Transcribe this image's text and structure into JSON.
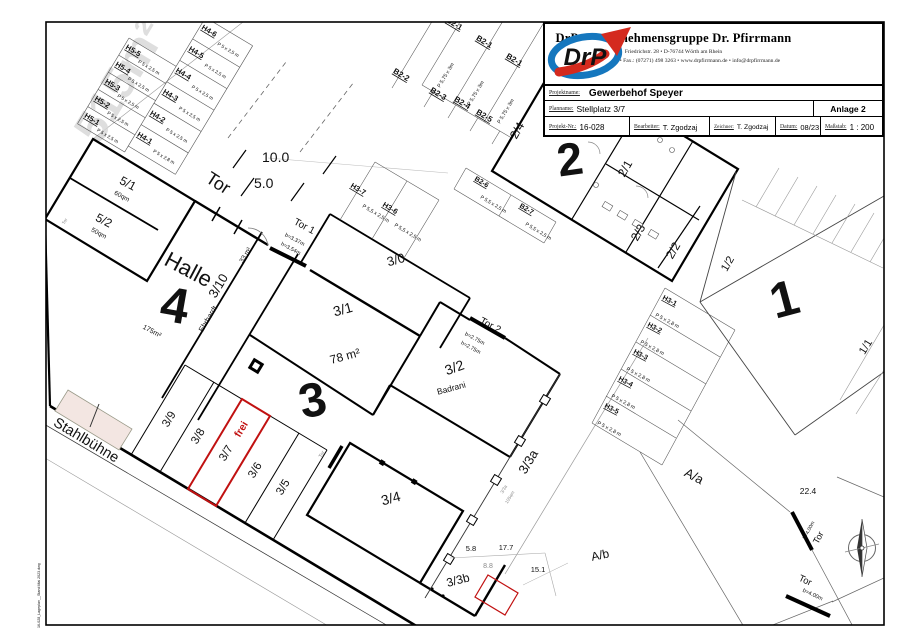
{
  "tb": {
    "company": "DrP - Unternehmensgruppe Dr. Pfirrmann",
    "address": "Friedrichstr. 28  •  D-76744 Wörth am Rhein",
    "contact": "Tel.: (07271) 498 2771  •  Fax.: (07271) 498 3263  •  www.drpfirrmann.de  •  info@drpfirrmann.de",
    "logo": "DrP",
    "projektname_label": "Projektname:",
    "projektname": "Gewerbehof Speyer",
    "planname_label": "Planname:",
    "planname": "Stellplatz 3/7",
    "anlage": "Anlage 2",
    "pnr_label": "Projekt-Nr.:",
    "pnr": "16-028",
    "bearb_label": "Bearbeiter:",
    "bearb": "T. Zgodzaj",
    "zeich_label": "Zeichner:",
    "zeich": "T. Zgodzaj",
    "datum_label": "Datum:",
    "datum": "08/23",
    "mass_label": "Maßstab:",
    "mass": "1 : 200"
  },
  "plan": {
    "watermark": "515m²",
    "scale10": "10.0",
    "scale5": "5.0",
    "street": "Stahlbühne",
    "filenote": "16-028_Lageplan__Stand Mai 2023.dwg",
    "big1": "1",
    "big2": "2",
    "big3": "3",
    "big4": "4",
    "halle": "Halle",
    "halle_area": "175m²"
  },
  "rooms": {
    "r51": "5/1",
    "r51a": "60qm",
    "r52": "5/2",
    "r52a": "50qm",
    "r310": "3/10",
    "r310a": "33 m²",
    "r310t": "Ehrhardt",
    "r30": "3/0",
    "r31": "3/1",
    "r31a": "78 m²",
    "r32": "3/2",
    "r32t": "Badrani",
    "r34": "3/4",
    "r33a": "3/3a",
    "r33a_note": "3/3a",
    "r33a_area": "105qm",
    "r33b": "3/3b",
    "r24": "2/4",
    "r21": "2/1",
    "r23": "2/3",
    "r22": "2/2",
    "r12": "1/2",
    "r11": "1/1",
    "aa": "A/a",
    "ab": "A/b",
    "r39": "3/9",
    "r38": "3/8",
    "r37": "3/7",
    "frei": "frei",
    "r36": "3/6",
    "r35": "3/5"
  },
  "stalls": {
    "h5": [
      {
        "id": "H5-5",
        "size": "P 5 x 2,5 m"
      },
      {
        "id": "H5-4",
        "size": "P 5 x 2,5 m"
      },
      {
        "id": "H5-3",
        "size": "P 5 x 2,5 m"
      },
      {
        "id": "H5-2",
        "size": "P 5 x 2,5 m"
      },
      {
        "id": "H5-1",
        "size": "P 5 x 2,5 m"
      }
    ],
    "h4": [
      {
        "id": "H4-6",
        "size": "P 5 x 2,5 m"
      },
      {
        "id": "H4-5",
        "size": "P 5 x 2,5 m"
      },
      {
        "id": "H4-4",
        "size": "P 5 x 2,5 m"
      },
      {
        "id": "H4-3",
        "size": "P 5 x 2,5 m"
      },
      {
        "id": "H4-2",
        "size": "P 5 x 2,5 m"
      },
      {
        "id": "H4-1",
        "size": "P 5 x 2,8 m"
      }
    ],
    "h3m": [
      {
        "id": "H3-7",
        "size": "P 5,5 x 2,5 m"
      },
      {
        "id": "H3-6",
        "size": "P 5,5 x 2,5 m"
      }
    ],
    "h3c": [
      {
        "id": "H3-1",
        "size": "P 5 x 2,8 m"
      },
      {
        "id": "H3-2",
        "size": "P 5 x 2,8 m"
      },
      {
        "id": "H3-3",
        "size": "P 5 x 2,8 m"
      },
      {
        "id": "H3-4",
        "size": "P 5 x 2,8 m"
      },
      {
        "id": "H3-5",
        "size": "P 5 x 2,8 m"
      }
    ],
    "b2t": [
      {
        "id": "B2-1",
        "size": "P 5,75 x 3m"
      },
      {
        "id": "B2-1",
        "size": "P 5,75 x 3m"
      },
      {
        "id": "B2-1",
        "size": "P 5,75 x 3m"
      }
    ],
    "b2c": [
      {
        "id": "B2-2"
      },
      {
        "id": "B2-3"
      },
      {
        "id": "B2-4"
      },
      {
        "id": "B2-5"
      }
    ],
    "b2l": [
      {
        "id": "B2-6",
        "size": "P 5,5 x 2,5 m"
      },
      {
        "id": "B2-7",
        "size": "P 5,5 x 2,5 m"
      }
    ]
  },
  "gates": {
    "tor": "Tor",
    "tor1": "Tor 1",
    "tor1b": "b=3.37m",
    "tor1h": "h=3.54m",
    "tor2": "Tor 2",
    "tor2b": "b=2.75m",
    "tor2h": "h=2.75m",
    "tora": "Tor",
    "torab": "b=4.00m",
    "torb": "Tor",
    "torbb": "b=4.00m",
    "tors": "Tor",
    "torw": "Tor"
  },
  "dims": {
    "a": "22.4",
    "b": "5.8",
    "c": "17.7",
    "d": "8.8",
    "e": "15.1"
  },
  "colors": {
    "highlight": "#c11111",
    "logo_blue": "#1577be",
    "logo_red": "#d42a1e"
  }
}
